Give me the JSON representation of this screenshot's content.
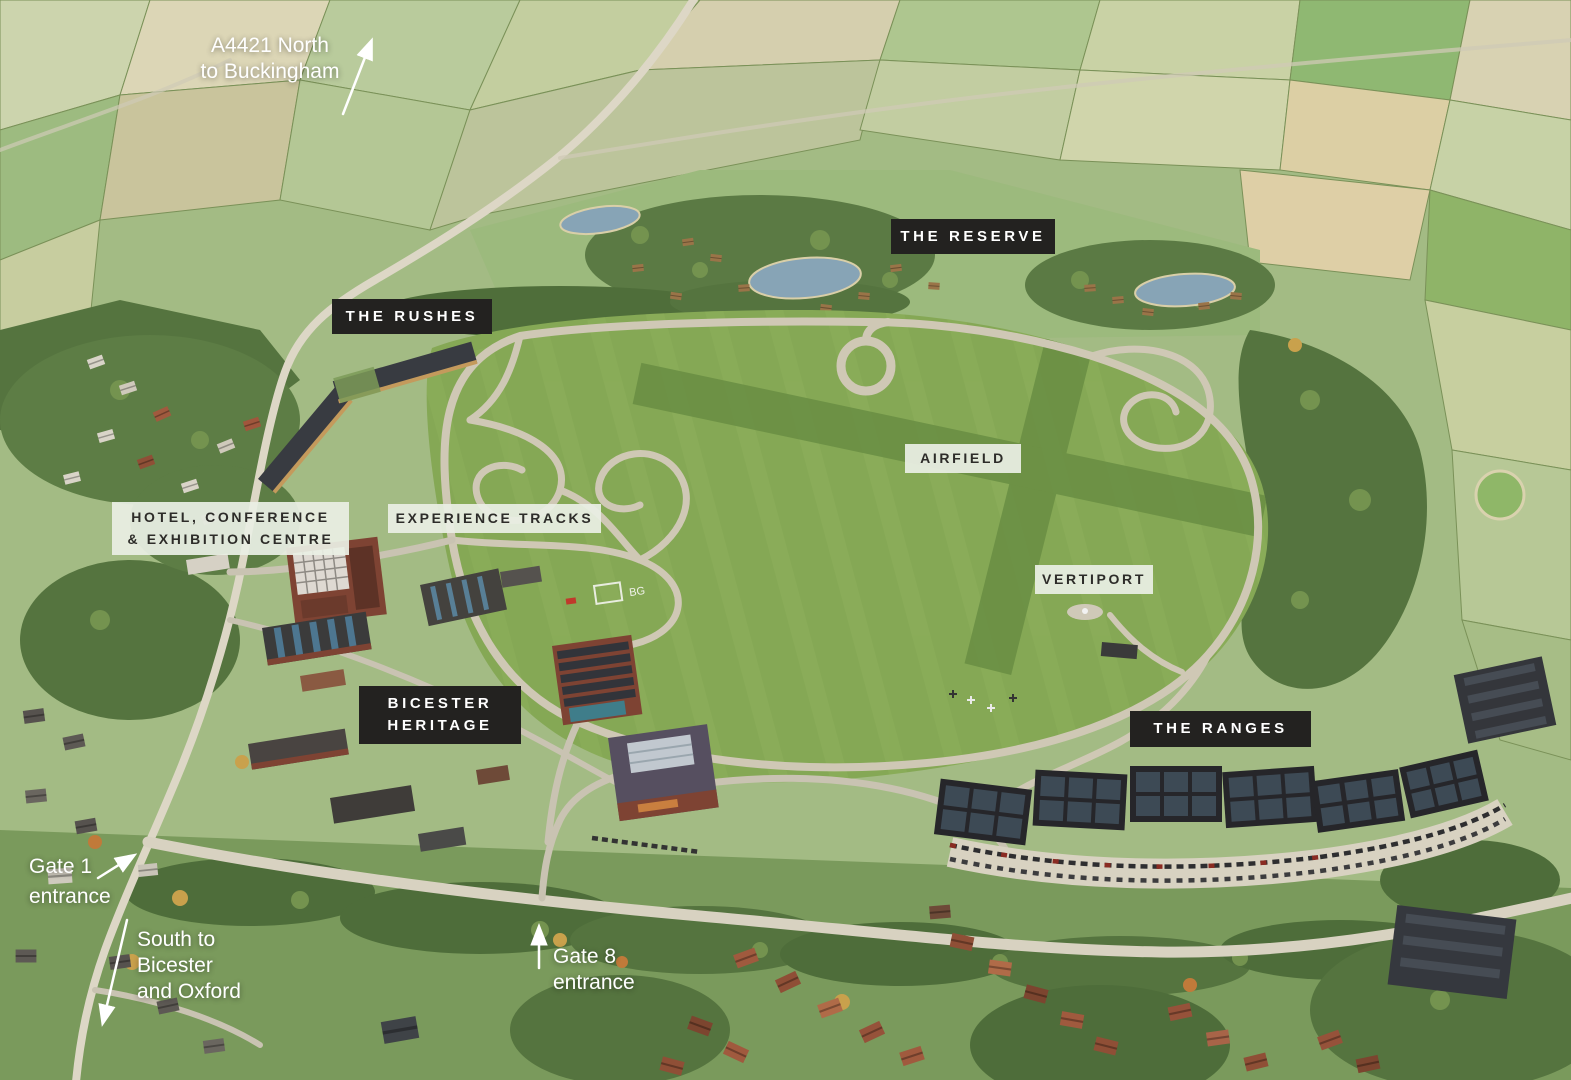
{
  "colors": {
    "badge_dark_bg": "#232220",
    "badge_dark_text": "#ffffff",
    "badge_light_bg": "#e9eee4",
    "badge_light_text": "#2d2c29",
    "annotation_text": "#ffffff",
    "airfield_grass": "#85a855",
    "woodland": "#55743f",
    "road": "#dbd5c4",
    "lake": "#87a4b6"
  },
  "area_labels": [
    {
      "id": "the-reserve",
      "text": "THE RESERVE",
      "style": "dark"
    },
    {
      "id": "the-rushes",
      "text": "THE RUSHES",
      "style": "dark"
    },
    {
      "id": "airfield",
      "text": "AIRFIELD",
      "style": "light"
    },
    {
      "id": "experience-tracks",
      "text": "EXPERIENCE TRACKS",
      "style": "light"
    },
    {
      "id": "hotel-conference-exhibition",
      "text": "HOTEL, CONFERENCE\n& EXHIBITION CENTRE",
      "style": "light"
    },
    {
      "id": "vertiport",
      "text": "VERTIPORT",
      "style": "light"
    },
    {
      "id": "bicester-heritage",
      "text": "BICESTER\nHERITAGE",
      "style": "dark"
    },
    {
      "id": "the-ranges",
      "text": "THE RANGES",
      "style": "dark"
    }
  ],
  "direction_labels": [
    {
      "id": "a4421-north",
      "text": "A4421 North\nto Buckingham"
    },
    {
      "id": "gate-1",
      "text": "Gate 1\nentrance"
    },
    {
      "id": "south-to-bicester",
      "text": "South to\nBicester\nand Oxford"
    },
    {
      "id": "gate-8",
      "text": "Gate 8\nentrance"
    }
  ],
  "ground_markings": {
    "helipad_code": "BG"
  }
}
